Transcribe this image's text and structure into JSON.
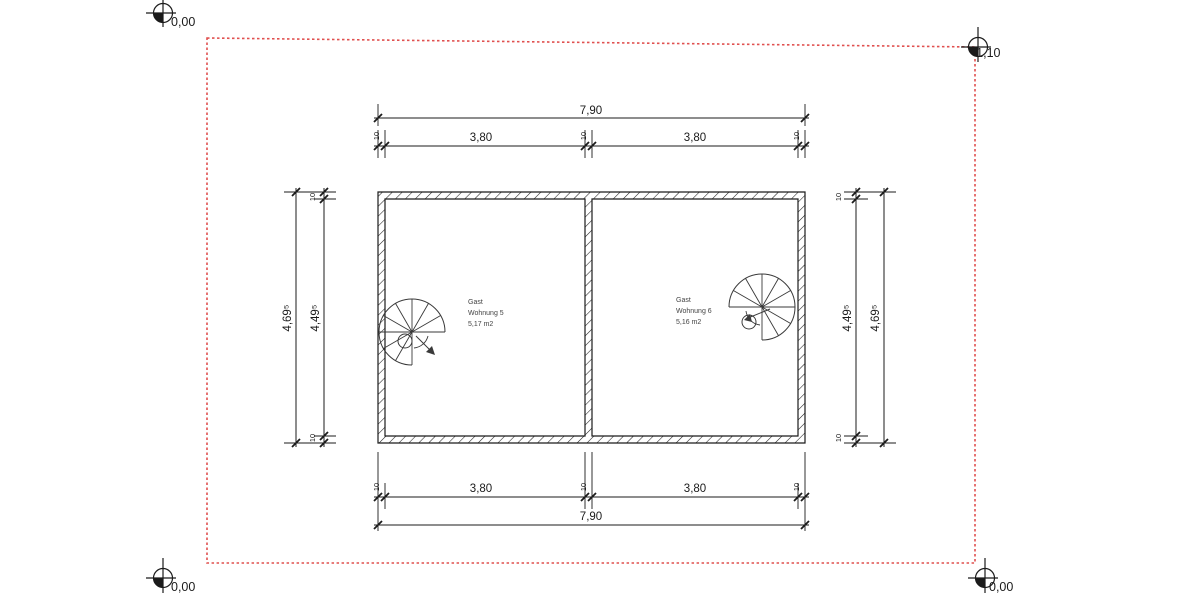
{
  "markers": {
    "top_left": "0,00",
    "top_right": "-1,10",
    "bottom_left": "0,00",
    "bottom_right": "0,00"
  },
  "dimensions": {
    "top_overall": "7,90",
    "top_segment_left": "3,80",
    "top_segment_right": "3,80",
    "bottom_overall": "7,90",
    "bottom_segment_left": "3,80",
    "bottom_segment_right": "3,80",
    "left_outer": "4,69⁵",
    "left_inner": "4,49⁵",
    "right_inner": "4,49⁵",
    "right_outer": "4,69⁵",
    "wall_thickness": "10"
  },
  "rooms": {
    "left": {
      "line1": "Gast",
      "line2": "Wohnung 5",
      "line3": "5,17 m2"
    },
    "right": {
      "line1": "Gast",
      "line2": "Wohnung 6",
      "line3": "5,16 m2"
    }
  },
  "colors": {
    "boundary_red": "#e0504f",
    "drawing_line": "#1b1b1b"
  }
}
